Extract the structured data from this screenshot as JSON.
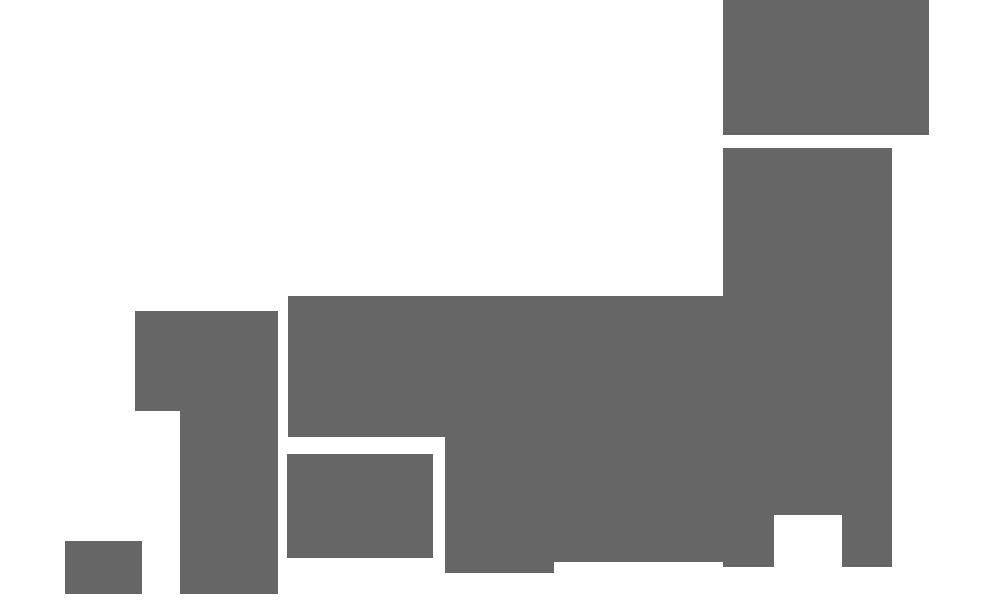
{
  "canvas": {
    "width": 1000,
    "height": 600,
    "background_color": "#ffffff"
  },
  "map": {
    "description": "blocky-rectangular-silhouette-map-of-japan",
    "block_color": "#666666",
    "blocks": [
      {
        "name": "hokkaido",
        "x": 723,
        "y": 0,
        "w": 206,
        "h": 135
      },
      {
        "name": "tohoku-main",
        "x": 723,
        "y": 148,
        "w": 169,
        "h": 367
      },
      {
        "name": "tohoku-leg-west",
        "x": 723,
        "y": 515,
        "w": 51,
        "h": 52
      },
      {
        "name": "tohoku-leg-east",
        "x": 842,
        "y": 515,
        "w": 50,
        "h": 52
      },
      {
        "name": "central-honshu-band",
        "x": 288,
        "y": 296,
        "w": 435,
        "h": 141
      },
      {
        "name": "kansai-block",
        "x": 445,
        "y": 437,
        "w": 109,
        "h": 136
      },
      {
        "name": "chubu-lower-block",
        "x": 554,
        "y": 437,
        "w": 169,
        "h": 125
      },
      {
        "name": "chugoku-upper",
        "x": 135,
        "y": 311,
        "w": 143,
        "h": 100
      },
      {
        "name": "chugoku-lower",
        "x": 180,
        "y": 411,
        "w": 98,
        "h": 183
      },
      {
        "name": "shikoku",
        "x": 287,
        "y": 454,
        "w": 146,
        "h": 104
      },
      {
        "name": "kyushu",
        "x": 65,
        "y": 541,
        "w": 77,
        "h": 53
      }
    ]
  }
}
